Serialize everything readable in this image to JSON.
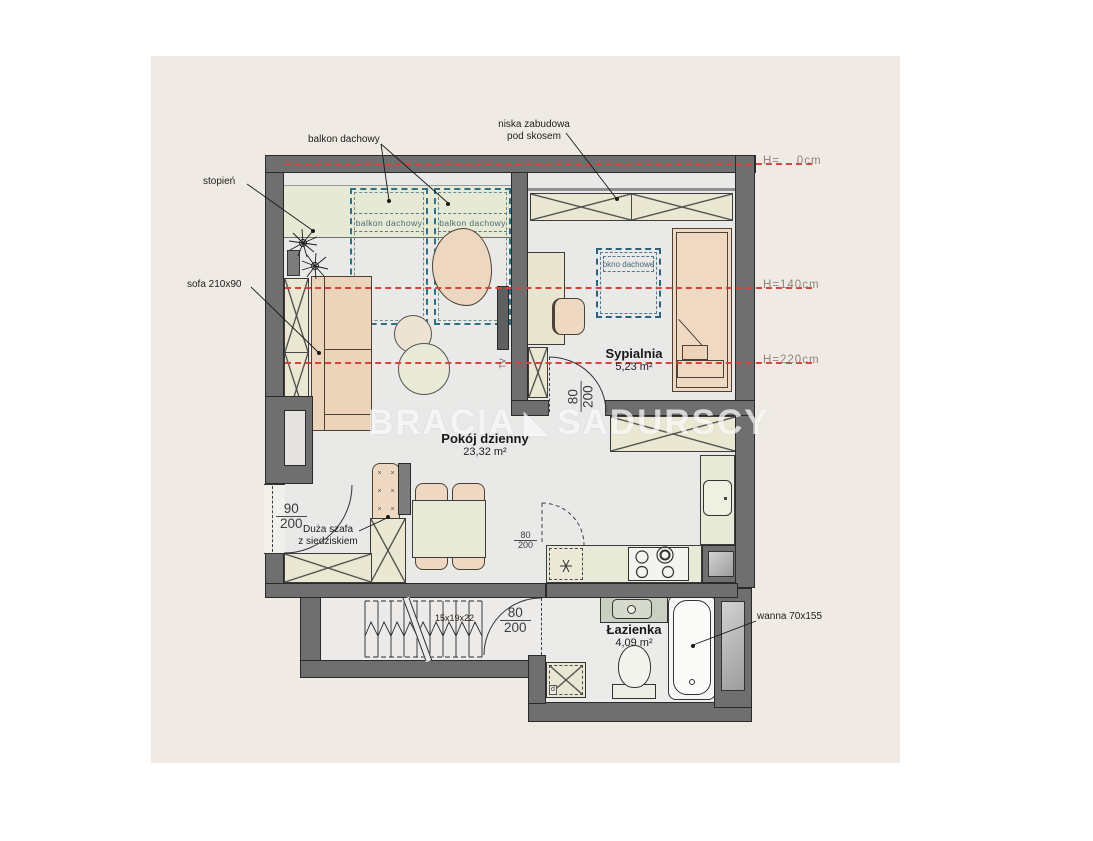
{
  "watermark": {
    "left": "BRACIA",
    "icon_glyph": "◣",
    "right": "SADURSCY"
  },
  "rooms": {
    "living": {
      "name": "Pokój dzienny",
      "area": "23,32 m²"
    },
    "bedroom": {
      "name": "Sypialnia",
      "area": "5,23 m²"
    },
    "bathroom": {
      "name": "Łazienka",
      "area": "4,09 m²"
    }
  },
  "callouts": {
    "balkon_dachowy": "balkon dachowy",
    "niska_line1": "niska zabudowa",
    "niska_line2": "pod skosem",
    "stopien": "stopień",
    "sofa": "sofa 210x90",
    "szafa_line1": "Duża szafa",
    "szafa_line2": "z siedziskiem",
    "wanna": "wanna 70x155"
  },
  "labels": {
    "balkon_box": "balkon dachowy",
    "okno_dachowe": "okno dachowe",
    "tv": "TV",
    "stairs_dim": "15x19x22",
    "washer_mark": "d"
  },
  "heights": [
    {
      "label": "H=    0cm"
    },
    {
      "label": "H=140cm"
    },
    {
      "label": "H=220cm"
    }
  ],
  "doors": {
    "entry_left": {
      "num": "90",
      "den": "200"
    },
    "bedroom": {
      "num": "80",
      "den": "200"
    },
    "bathroom": {
      "num": "80",
      "den": "200"
    },
    "kitchen": {
      "num": "80",
      "den": "200"
    }
  },
  "colors": {
    "wall": "#6f6f6f",
    "height_line_dashed": "#d8423a",
    "balcony_dashed": "#2e7086",
    "floor": "#e9e9e8",
    "furniture_wood": "#eed8c1",
    "builtin_cream": "#eae7d2",
    "terrace_green": "#e6e9d4",
    "paper_cream": "#efebe4"
  }
}
